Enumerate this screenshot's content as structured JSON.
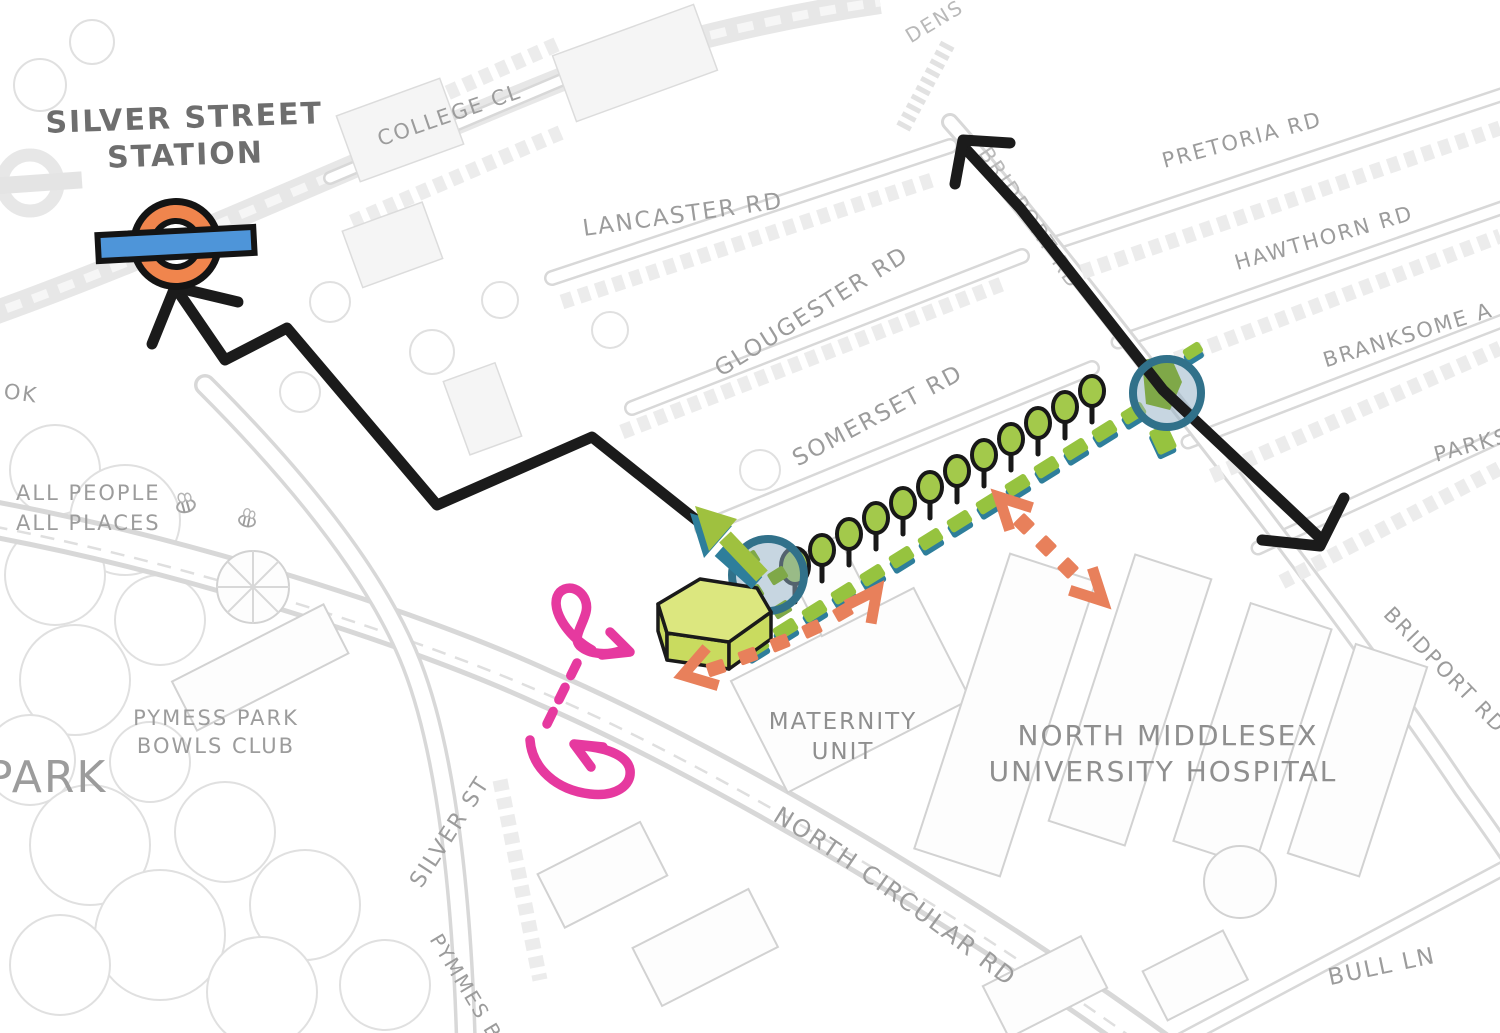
{
  "colors": {
    "roundel_orange": "#F0854D",
    "roundel_bar_blue": "#4E95D9",
    "route_black": "#1B1B1B",
    "promenade_green": "#96C33F",
    "promenade_shadow_teal": "#2E7E9B",
    "tree_green": "#A3C94B",
    "building_top_green": "#DCE77F",
    "building_side_green": "#C9DB5F",
    "circle_ring_teal": "#31718A",
    "circle_fill_blue": "#8FAEC4",
    "crossing_green": "#7FA848",
    "arrow_coral": "#E8805B",
    "route_pink": "#E6399F",
    "map_line_gray": "#D8D8D8",
    "label_gray": "#9C9C9C",
    "label_dark_gray": "#6E6E6E"
  },
  "labels": {
    "station_line1": "SILVER STREET",
    "station_line2": "STATION",
    "college_cl": "COLLEGE CL",
    "gardens_partial": "DENS",
    "lancaster_rd": "LANCASTER RD",
    "gloucester_rd": "GLOUGESTER RD",
    "somerset_rd": "SOMERSET RD",
    "pretoria_rd": "PRETORIA RD",
    "hawthorn_rd": "HAWTHORN RD",
    "branksome_ave_partial": "BRANKSOME A",
    "parkside_partial": "PARKS",
    "bridport_rd_north": "BRIDPORT RD",
    "bridport_rd_south": "BRIDPORT RD",
    "north_circular_rd": "NORTH CIRCULAR RD",
    "silver_st": "SILVER ST",
    "pymmes_brook_partial": "PYMMES B",
    "brook_partial": "OK",
    "park": "PARK",
    "all_people_line1": "ALL PEOPLE",
    "all_people_line2": "ALL PLACES",
    "bowls_line1": "PYMESS PARK",
    "bowls_line2": "BOWLS CLUB",
    "maternity_line1": "MATERNITY",
    "maternity_line2": "UNIT",
    "hospital_line1": "NORTH MIDDLESEX",
    "hospital_line2": "UNIVERSITY HOSPITAL",
    "bull_ln": "BULL LN"
  }
}
